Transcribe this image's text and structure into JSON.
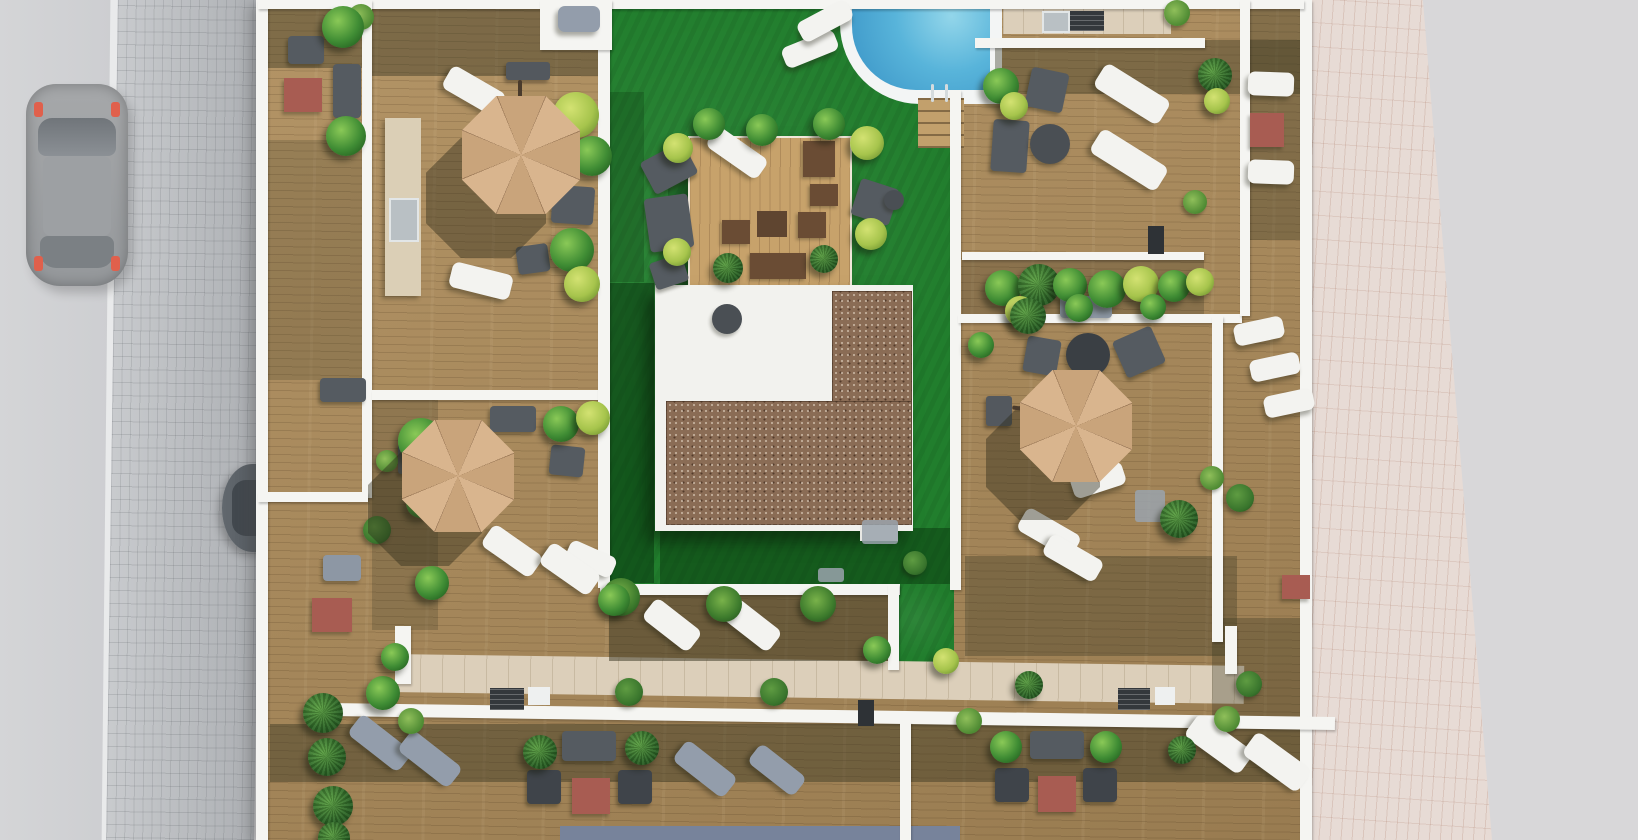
{
  "scene": {
    "description": "Aerial 3D architectural rendering of a residential rooftop terrace complex: private wooden deck terraces with beige octagonal parasols, sun loungers and lounge sets around a central communal garden with bright green lawn, swimming pool with ladder and steps, timber pergola platform, white building core with gravel roof, travertine BBQ walkway, cobblestone and pink paver sidewalks, and a street with two parked cars",
    "palette": {
      "road_left": "#d4d5d7",
      "road_right": "#d8d7d9",
      "curb": "#e9eaeb",
      "sidewalk_cobble": "#b6b9bd",
      "sidewalk_pavers": "#e7dbd5",
      "wood_deck": "#ab8b5c",
      "wood_platform": "#c7a26b",
      "travertine": "#dccfba",
      "wall_white": "#f5f5f2",
      "lawn": "#217e2d",
      "lawn_dark": "#145121",
      "pool_water": "#58b4da",
      "pool_water_deep": "#3d97c8",
      "gravel": "#8a6c55",
      "umbrella": "#d9b58e",
      "umbrella_alt": "#c9a47b",
      "cushion_blue": "#a9bcd0",
      "furniture_frame": "#555b61",
      "white_furniture": "#f3f3f0",
      "gray_furniture": "#939dab",
      "table_red": "#a85c52",
      "plant_green": "#3f8c34",
      "plant_yellow": "#a6c44c",
      "plant_dark": "#2c6526",
      "car_gray": "#a6a8aa",
      "car_dark": "#62686e",
      "glass": "#77839b"
    },
    "objects": {
      "walls": [
        [
          256,
          0,
          12,
          840
        ],
        [
          1300,
          0,
          12,
          840
        ],
        [
          258,
          0,
          1046,
          9
        ],
        [
          362,
          0,
          10,
          498
        ],
        [
          258,
          492,
          110,
          10
        ],
        [
          372,
          390,
          236,
          10
        ],
        [
          598,
          0,
          12,
          588
        ],
        [
          600,
          584,
          300,
          11
        ],
        [
          888,
          584,
          11,
          86
        ],
        [
          950,
          90,
          11,
          500
        ],
        [
          975,
          38,
          230,
          10
        ],
        [
          962,
          252,
          242,
          8
        ],
        [
          958,
          314,
          284,
          9
        ],
        [
          1240,
          0,
          10,
          316
        ],
        [
          1212,
          316,
          11,
          326
        ],
        [
          330,
          710,
          1005,
          13,
          0.8
        ],
        [
          395,
          626,
          16,
          58
        ],
        [
          900,
          722,
          11,
          118
        ],
        [
          1225,
          626,
          12,
          48
        ],
        [
          540,
          0,
          72,
          50
        ]
      ],
      "shadows": [
        [
          258,
          0,
          104,
          68,
          0.4
        ],
        [
          258,
          140,
          106,
          240,
          0.2
        ],
        [
          365,
          0,
          240,
          76,
          0.42
        ],
        [
          995,
          40,
          308,
          54,
          0.38
        ],
        [
          1240,
          0,
          60,
          240,
          0.32
        ],
        [
          965,
          556,
          272,
          100,
          0.32
        ],
        [
          609,
          595,
          280,
          66,
          0.5
        ],
        [
          270,
          724,
          1030,
          58,
          0.42
        ],
        [
          372,
          400,
          66,
          230,
          0.22
        ],
        [
          962,
          260,
          242,
          56,
          0.25
        ],
        [
          1212,
          618,
          88,
          104,
          0.3
        ]
      ],
      "lawn_shadows": [
        [
          608,
          283,
          46,
          300,
          0.5
        ],
        [
          660,
          528,
          292,
          56,
          0.45
        ],
        [
          690,
          292,
          160,
          24,
          0.4
        ],
        [
          668,
          138,
          22,
          150,
          0.3
        ],
        [
          608,
          92,
          36,
          190,
          0.25
        ]
      ],
      "umbrellas": [
        [
          462,
          96,
          118
        ],
        [
          402,
          420,
          112
        ],
        [
          1020,
          370,
          112
        ]
      ],
      "umbrella_shadows": [
        [
          426,
          138,
          120
        ],
        [
          368,
          452,
          114
        ],
        [
          986,
          406,
          114
        ]
      ],
      "umbrella_arms": [
        [
          518,
          80,
          4,
          28,
          0
        ],
        [
          428,
          464,
          44,
          4,
          -6
        ],
        [
          1012,
          410,
          66,
          4,
          8
        ]
      ],
      "umbrella_bases": [
        [
          506,
          62,
          44,
          18,
          "d"
        ],
        [
          398,
          444,
          28,
          30,
          "w"
        ],
        [
          986,
          396,
          26,
          30,
          "w"
        ]
      ],
      "loungers": [
        [
          782,
          38,
          56,
          22,
          -22,
          "w"
        ],
        [
          797,
          10,
          56,
          22,
          -28,
          "w"
        ],
        [
          443,
          78,
          62,
          26,
          30,
          "w"
        ],
        [
          450,
          268,
          62,
          26,
          14,
          "w"
        ],
        [
          706,
          141,
          62,
          24,
          35,
          "w"
        ],
        [
          1094,
          80,
          76,
          28,
          32,
          "w"
        ],
        [
          1090,
          146,
          78,
          28,
          32,
          "w"
        ],
        [
          1071,
          468,
          54,
          24,
          -18,
          "w"
        ],
        [
          1018,
          520,
          62,
          26,
          30,
          "w"
        ],
        [
          1043,
          546,
          60,
          24,
          30,
          "w"
        ],
        [
          1248,
          72,
          46,
          24,
          2,
          "w"
        ],
        [
          1248,
          160,
          46,
          24,
          2,
          "w"
        ],
        [
          1234,
          320,
          50,
          22,
          -12,
          "w"
        ],
        [
          1250,
          356,
          50,
          22,
          -12,
          "w"
        ],
        [
          1264,
          392,
          50,
          22,
          -12,
          "w"
        ],
        [
          643,
          612,
          58,
          26,
          38,
          "w"
        ],
        [
          723,
          612,
          58,
          26,
          38,
          "w"
        ],
        [
          566,
          548,
          50,
          22,
          24,
          "w"
        ],
        [
          482,
          538,
          60,
          26,
          35,
          "w"
        ],
        [
          540,
          556,
          60,
          26,
          35,
          "w"
        ],
        [
          348,
          730,
          64,
          26,
          38,
          "g"
        ],
        [
          398,
          746,
          64,
          26,
          38,
          "g"
        ],
        [
          673,
          756,
          64,
          26,
          38,
          "g"
        ],
        [
          748,
          758,
          58,
          24,
          38,
          "g"
        ],
        [
          1185,
          730,
          68,
          28,
          36,
          "w"
        ],
        [
          1243,
          748,
          68,
          28,
          36,
          "w"
        ],
        [
          558,
          6,
          42,
          26,
          0,
          "g"
        ]
      ],
      "sofas": [
        [
          333,
          64,
          28,
          54,
          0
        ],
        [
          320,
          378,
          46,
          24,
          0
        ],
        [
          552,
          186,
          42,
          38,
          4
        ],
        [
          490,
          406,
          46,
          26,
          0
        ],
        [
          645,
          150,
          48,
          36,
          -28
        ],
        [
          647,
          196,
          44,
          54,
          -8
        ],
        [
          992,
          120,
          36,
          52,
          4
        ],
        [
          562,
          731,
          54,
          30,
          0
        ],
        [
          1030,
          731,
          54,
          28,
          0
        ]
      ],
      "armchairs": [
        [
          288,
          36,
          36,
          28,
          0,
          "b"
        ],
        [
          517,
          245,
          32,
          28,
          -8,
          "b"
        ],
        [
          550,
          446,
          34,
          30,
          6,
          "b"
        ],
        [
          652,
          258,
          34,
          28,
          -18,
          "b"
        ],
        [
          855,
          183,
          40,
          38,
          18,
          "b"
        ],
        [
          1028,
          70,
          38,
          40,
          12,
          "b"
        ],
        [
          1025,
          338,
          34,
          36,
          10,
          "b"
        ],
        [
          1118,
          332,
          42,
          40,
          -24,
          "b"
        ],
        [
          527,
          770,
          34,
          34,
          0,
          "d"
        ],
        [
          618,
          770,
          34,
          34,
          0,
          "d"
        ],
        [
          995,
          768,
          34,
          34,
          0,
          "d"
        ],
        [
          1083,
          768,
          34,
          34,
          0,
          "d"
        ]
      ],
      "benches": [
        [
          1060,
          296,
          52,
          22,
          0
        ],
        [
          323,
          555,
          38,
          26,
          0
        ]
      ],
      "platform_seats": [
        [
          803,
          141,
          32,
          36
        ],
        [
          810,
          184,
          28,
          22
        ],
        [
          722,
          220,
          28,
          24
        ],
        [
          798,
          212,
          28,
          26
        ],
        [
          750,
          253,
          56,
          26
        ]
      ],
      "tables_brown": [
        [
          757,
          211,
          30,
          26
        ]
      ],
      "tables_red": [
        [
          284,
          78,
          38,
          34
        ],
        [
          312,
          598,
          40,
          34
        ],
        [
          572,
          778,
          38,
          36
        ],
        [
          1038,
          776,
          38,
          36
        ],
        [
          1250,
          113,
          34,
          34
        ],
        [
          1282,
          575,
          28,
          24
        ]
      ],
      "tables_round": [
        [
          1030,
          124,
          40
        ],
        [
          884,
          190,
          20
        ],
        [
          712,
          304,
          30
        ]
      ],
      "firepits": [
        [
          1066,
          333,
          44
        ]
      ],
      "counters": [
        [
          385,
          118,
          36,
          178
        ]
      ],
      "sinks": [
        [
          389,
          198,
          26,
          40
        ],
        [
          1042,
          11,
          24,
          18
        ]
      ],
      "grills": [
        [
          490,
          688,
          34,
          22
        ],
        [
          1118,
          688,
          32,
          22
        ],
        [
          1070,
          11,
          34,
          20
        ]
      ],
      "boards": [
        [
          528,
          687,
          22,
          18
        ],
        [
          1155,
          687,
          20,
          18
        ]
      ],
      "mats": [
        [
          862,
          520,
          36,
          24
        ],
        [
          1135,
          490,
          30,
          32
        ],
        [
          818,
          568,
          26,
          14
        ]
      ],
      "pots": [
        [
          348,
          4,
          26
        ],
        [
          1164,
          0,
          26
        ],
        [
          398,
          708,
          26
        ],
        [
          956,
          708,
          26
        ],
        [
          1214,
          706,
          26
        ],
        [
          1200,
          466,
          24
        ],
        [
          1183,
          190,
          24
        ],
        [
          376,
          450,
          22
        ]
      ],
      "pot_plants": [
        [
          706,
          586,
          36
        ],
        [
          800,
          586,
          36
        ],
        [
          602,
          578,
          38
        ]
      ],
      "dark_boxes": [
        [
          1148,
          226,
          16,
          28
        ],
        [
          858,
          700,
          16,
          26
        ]
      ],
      "plants": [
        [
          322,
          6,
          42,
          "g"
        ],
        [
          326,
          116,
          40,
          "g"
        ],
        [
          553,
          92,
          46,
          "y"
        ],
        [
          572,
          136,
          40,
          "g"
        ],
        [
          550,
          228,
          44,
          "g"
        ],
        [
          564,
          266,
          36,
          "y"
        ],
        [
          363,
          516,
          28,
          "t"
        ],
        [
          398,
          418,
          46,
          "g"
        ],
        [
          543,
          406,
          36,
          "g"
        ],
        [
          576,
          401,
          34,
          "y"
        ],
        [
          406,
          488,
          30,
          "g"
        ],
        [
          415,
          566,
          34,
          "g"
        ],
        [
          598,
          584,
          32,
          "g"
        ],
        [
          693,
          108,
          32,
          "g"
        ],
        [
          746,
          114,
          32,
          "g"
        ],
        [
          813,
          108,
          32,
          "g"
        ],
        [
          663,
          133,
          30,
          "y"
        ],
        [
          850,
          126,
          34,
          "y"
        ],
        [
          855,
          218,
          32,
          "y"
        ],
        [
          713,
          253,
          30,
          "p"
        ],
        [
          810,
          245,
          28,
          "p"
        ],
        [
          663,
          238,
          28,
          "y"
        ],
        [
          983,
          68,
          36,
          "g"
        ],
        [
          1000,
          92,
          28,
          "y"
        ],
        [
          1198,
          58,
          34,
          "p"
        ],
        [
          1204,
          88,
          26,
          "y"
        ],
        [
          985,
          270,
          36,
          "g"
        ],
        [
          1018,
          264,
          42,
          "p"
        ],
        [
          1053,
          268,
          34,
          "g"
        ],
        [
          1088,
          270,
          38,
          "g"
        ],
        [
          1123,
          266,
          36,
          "y"
        ],
        [
          1158,
          270,
          32,
          "g"
        ],
        [
          1186,
          268,
          28,
          "y"
        ],
        [
          1005,
          296,
          30,
          "y"
        ],
        [
          1065,
          294,
          28,
          "g"
        ],
        [
          1140,
          294,
          26,
          "g"
        ],
        [
          1010,
          298,
          36,
          "p"
        ],
        [
          968,
          332,
          26,
          "g"
        ],
        [
          1160,
          500,
          38,
          "p"
        ],
        [
          1226,
          484,
          28,
          "t"
        ],
        [
          615,
          678,
          28,
          "t"
        ],
        [
          760,
          678,
          28,
          "t"
        ],
        [
          903,
          551,
          24,
          "t"
        ],
        [
          303,
          693,
          40,
          "p"
        ],
        [
          308,
          738,
          38,
          "p"
        ],
        [
          313,
          786,
          40,
          "p"
        ],
        [
          318,
          822,
          32,
          "p"
        ],
        [
          366,
          676,
          34,
          "g"
        ],
        [
          381,
          643,
          28,
          "g"
        ],
        [
          523,
          735,
          34,
          "p"
        ],
        [
          625,
          731,
          34,
          "p"
        ],
        [
          990,
          731,
          32,
          "g"
        ],
        [
          1090,
          731,
          32,
          "g"
        ],
        [
          1168,
          736,
          28,
          "p"
        ],
        [
          1015,
          671,
          28,
          "p"
        ],
        [
          1236,
          671,
          26,
          "t"
        ],
        [
          863,
          636,
          28,
          "g"
        ],
        [
          933,
          648,
          26,
          "y"
        ]
      ]
    }
  }
}
